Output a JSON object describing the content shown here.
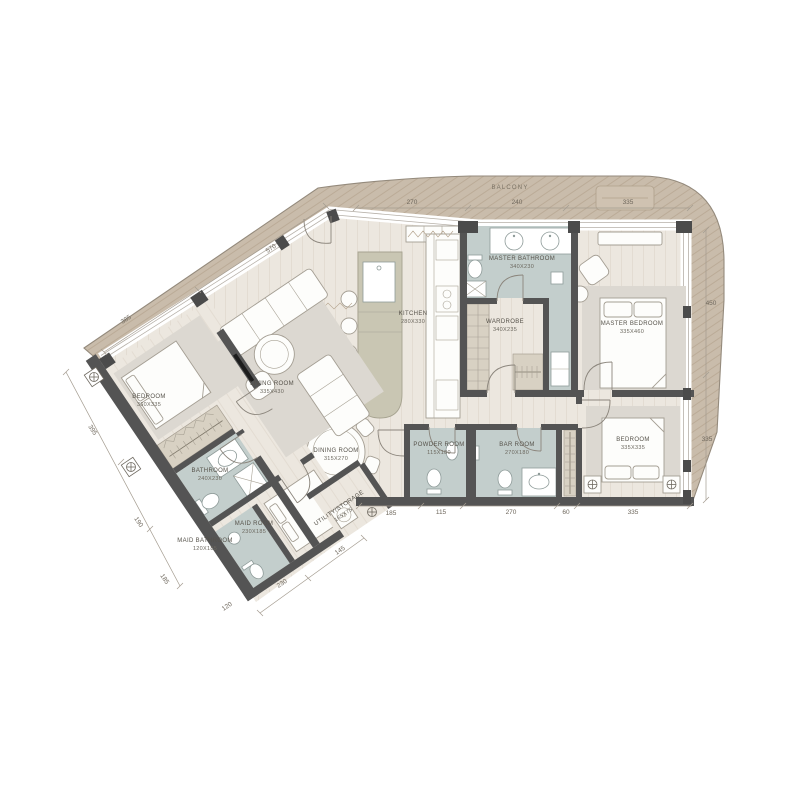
{
  "plan": {
    "balcony_label": "BALCONY",
    "rooms": [
      {
        "name": "MASTER BATHROOM",
        "dims": "340X230"
      },
      {
        "name": "WARDROBE",
        "dims": "340X235"
      },
      {
        "name": "MASTER BEDROOM",
        "dims": "335X460"
      },
      {
        "name": "KITCHEN",
        "dims": "280X330"
      },
      {
        "name": "LIVING ROOM",
        "dims": "335X430"
      },
      {
        "name": "DINING ROOM",
        "dims": "315X270"
      },
      {
        "name": "BEDROOM",
        "dims": "360X335"
      },
      {
        "name": "BATHROOM",
        "dims": "240X230"
      },
      {
        "name": "MAID BATHROOM",
        "dims": "120X185"
      },
      {
        "name": "MAID ROOM",
        "dims": "230X185"
      },
      {
        "name": "UTILITY/STORAGE",
        "dims": "165X75"
      },
      {
        "name": "POWDER ROOM",
        "dims": "115X180"
      },
      {
        "name": "BAR ROOM",
        "dims": "270X180"
      },
      {
        "name": "BEDROOM",
        "dims": "335X335"
      }
    ],
    "dims": {
      "top": [
        "270",
        "240",
        "335"
      ],
      "right": [
        "450",
        "335"
      ],
      "balcony_edge": [
        "570",
        "385"
      ],
      "left": [
        "395",
        "190",
        "185"
      ],
      "wing_bottom": [
        "120",
        "230",
        "145"
      ],
      "bottom": [
        "185",
        "115",
        "270",
        "60",
        "335"
      ]
    },
    "colors": {
      "balcony": "#c9bcab",
      "floor": "#ece7df",
      "wall": "#545454",
      "wet_room": "#c3cecc",
      "closet": "#d8d1c3",
      "text": "#56524a"
    }
  }
}
